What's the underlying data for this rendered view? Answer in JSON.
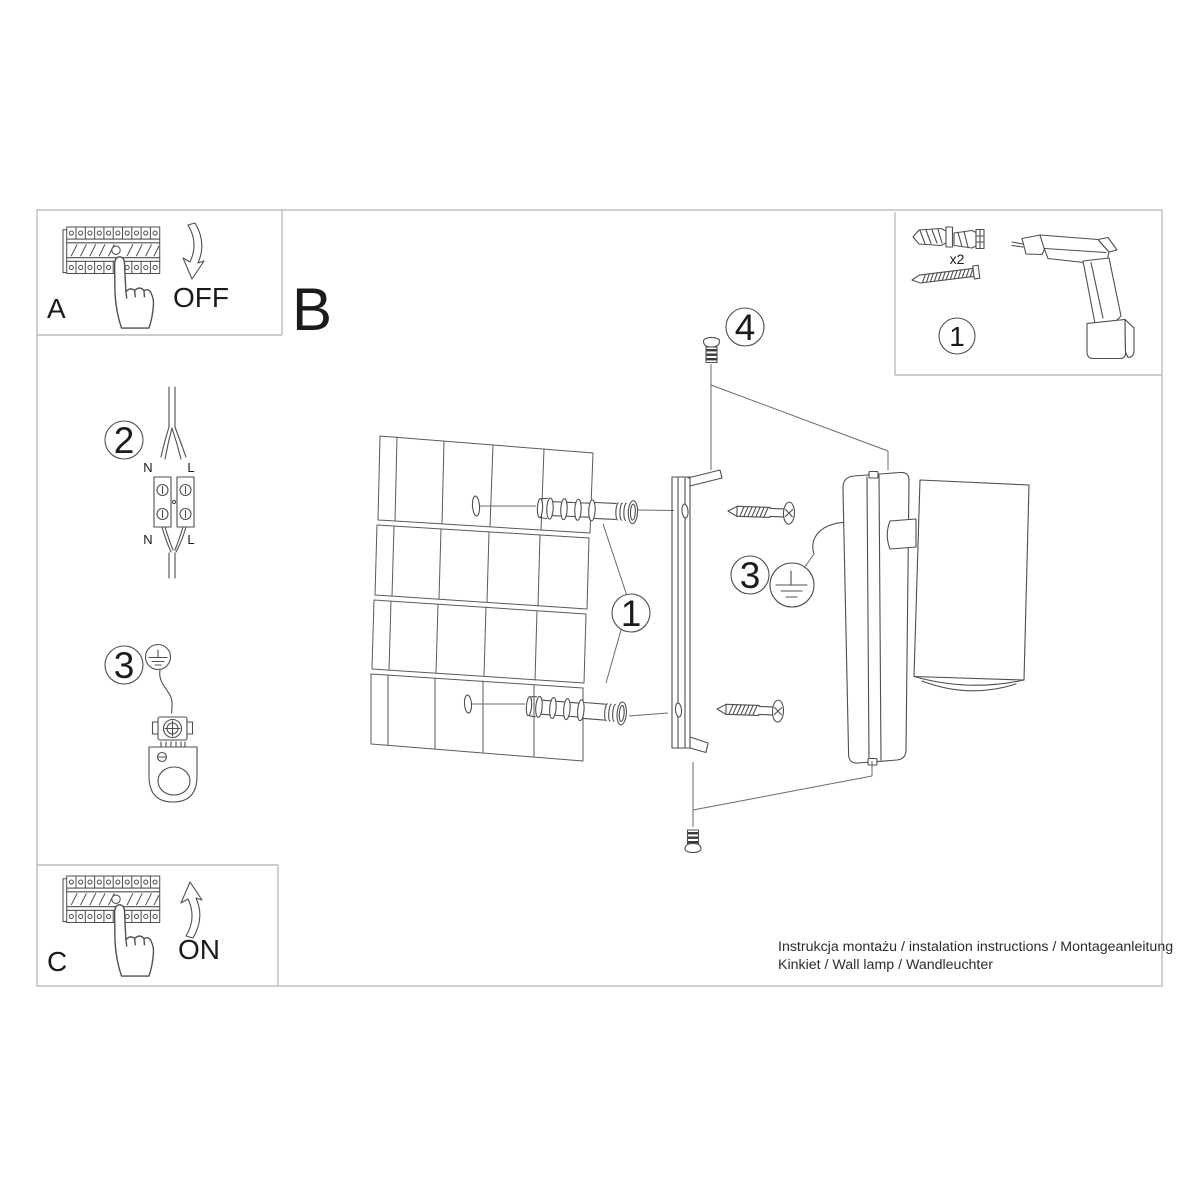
{
  "sheet": {
    "background": "#ffffff",
    "line_color": "#4f4f4f",
    "border_color": "#bcbcbc",
    "text_color": "#1b1b1b"
  },
  "panel_a": {
    "label": "A",
    "state": "OFF"
  },
  "panel_b": {
    "label": "B"
  },
  "panel_c": {
    "label": "C",
    "state": "ON"
  },
  "panel_tools": {
    "step": "1",
    "plug_quantity": "x2"
  },
  "step_wiring": {
    "step": "2",
    "top_left": "N",
    "top_right": "L",
    "bottom_left": "N",
    "bottom_right": "L"
  },
  "step_ground": {
    "step": "3"
  },
  "callouts": {
    "plugs": "1",
    "ground": "3",
    "top_screw": "4"
  },
  "footer": {
    "line1": "Instrukcja montażu / instalation instructions / Montageanleitung",
    "line2": "Kinkiet / Wall lamp / Wandleuchter"
  }
}
